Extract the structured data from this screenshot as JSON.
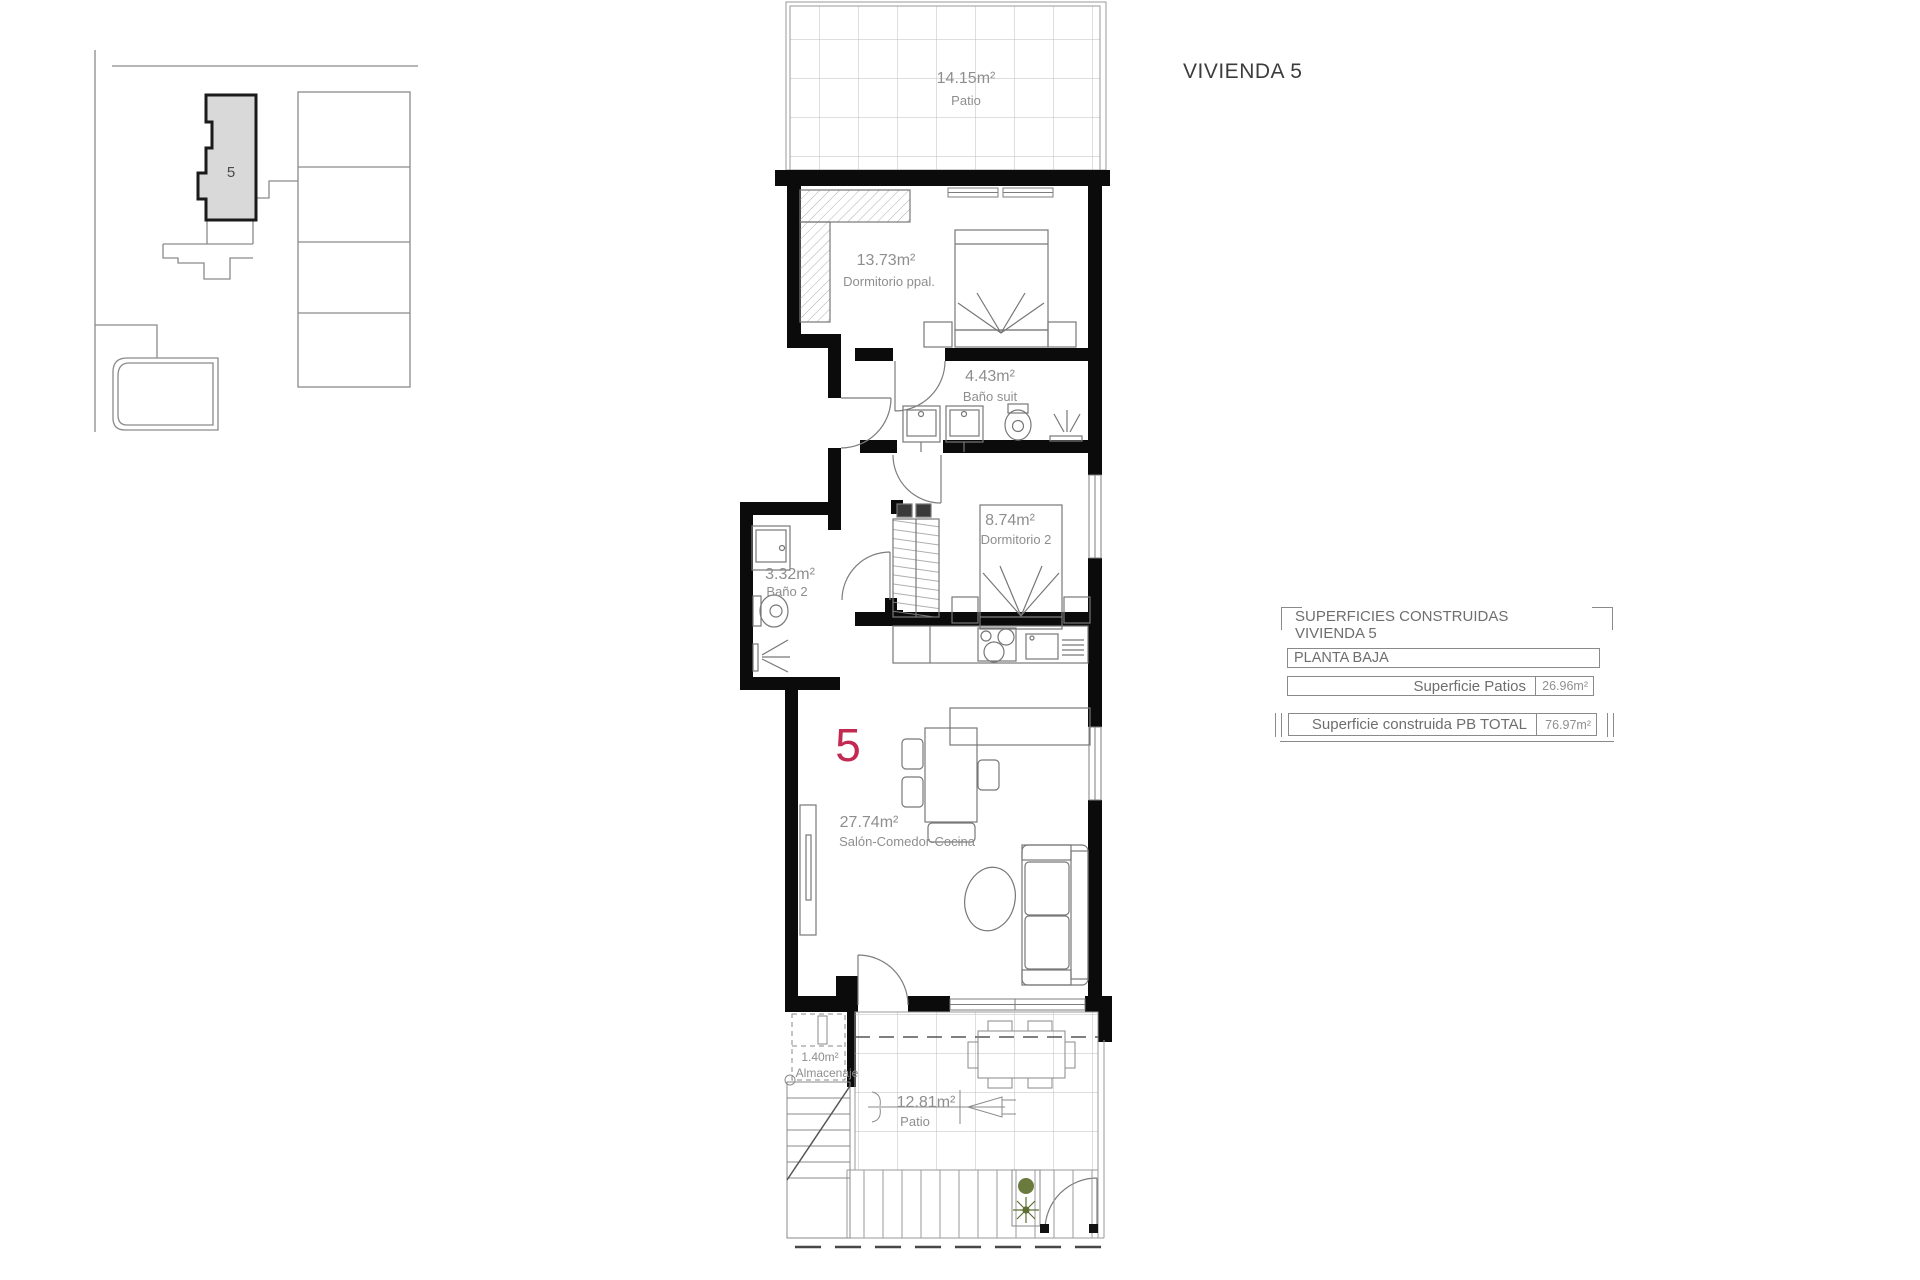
{
  "title": "VIVIENDA 5",
  "site_plan": {
    "unit_label": "5"
  },
  "floor_plan": {
    "unit_number": "5",
    "rooms": [
      {
        "area": "14.15m²",
        "name": "Patio"
      },
      {
        "area": "13.73m²",
        "name": "Dormitorio ppal."
      },
      {
        "area": "4.43m²",
        "name": "Baño suit"
      },
      {
        "area": "8.74m²",
        "name": "Dormitorio 2"
      },
      {
        "area": "3.32m²",
        "name": "Baño 2"
      },
      {
        "area": "27.74m²",
        "name": "Salón-Comedor-Cocina"
      },
      {
        "area": "1.40m²",
        "name": "Almacenaje"
      },
      {
        "area": "12.81m²",
        "name": "Patio"
      }
    ]
  },
  "summary_table": {
    "header_line1": "SUPERFICIES CONSTRUIDAS",
    "header_line2": "VIVIENDA 5",
    "section": "PLANTA BAJA",
    "rows": [
      {
        "label": "Superficie Patios",
        "value": "26.96m²"
      },
      {
        "label": "Superficie construida PB TOTAL",
        "value": "76.97m²"
      }
    ]
  },
  "colors": {
    "accent_red": "#c22a52",
    "wall_black": "#0b0b0b",
    "label_gray": "#8e8e8e",
    "unit_fill": "#d9d9d9"
  }
}
